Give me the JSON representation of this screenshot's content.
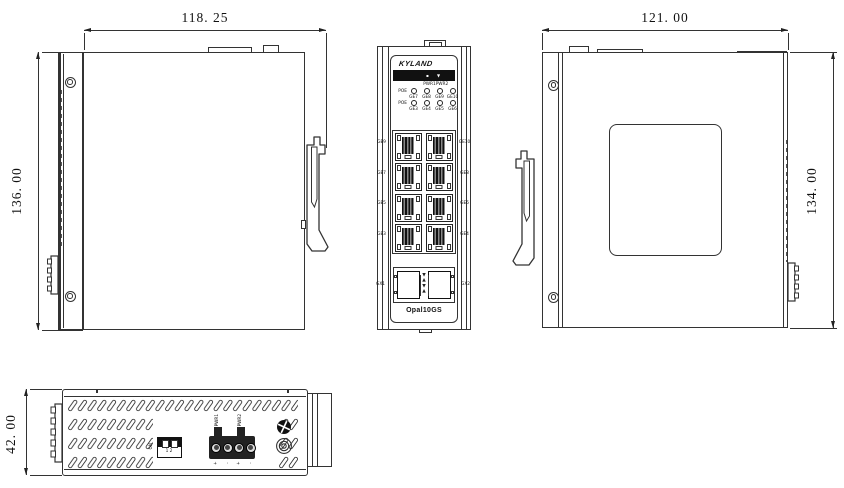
{
  "drawing": {
    "left_view": {
      "width_dim": "118. 25",
      "height_dim": "136. 00"
    },
    "right_view": {
      "width_dim": "121. 00",
      "height_dim": "134. 00"
    },
    "bottom_view": {
      "height_dim": "42. 00",
      "dip_switch": {
        "side_label": "ON",
        "positions": "1 2"
      },
      "power_input": {
        "terminals": [
          "PWR1",
          "PWR2"
        ],
        "polarity": [
          "+",
          "-",
          "+",
          "-"
        ]
      }
    },
    "front_view": {
      "brand": "KYLAND",
      "model": "Opal10GS",
      "power_leds": [
        "PWR1",
        "PWR2"
      ],
      "led_rows": [
        {
          "group": "POE",
          "ports": [
            "GE7",
            "GE8",
            "GE9",
            "GE10"
          ]
        },
        {
          "group": "POE",
          "ports": [
            "GE3",
            "GE4",
            "GE5",
            "GE6"
          ]
        }
      ],
      "port_labels_left": [
        "GE9",
        "GE7",
        "GE5",
        "GE3"
      ],
      "port_labels_right": [
        "GE10",
        "GE8",
        "GE6",
        "GE4"
      ],
      "sfp_labels": [
        "GX1",
        "GX2"
      ]
    },
    "icons": {
      "band_marks": [
        "▪",
        "▼"
      ],
      "sfp_arrows": [
        "▼",
        "▲",
        "▼",
        "▲"
      ]
    },
    "colors": {
      "line": "#333333",
      "panel_black": "#111111",
      "background": "#ffffff"
    }
  }
}
